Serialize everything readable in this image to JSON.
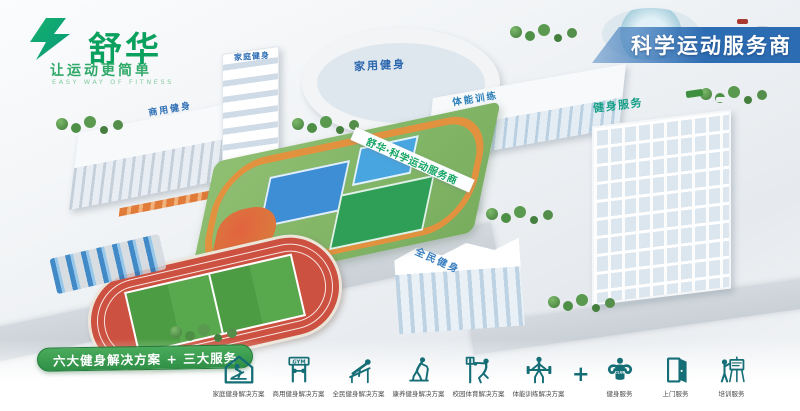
{
  "colors": {
    "brand_green": "#0aa05e",
    "ribbon_blue": "#2c6cb3",
    "banner_green": "#2e8f46",
    "icon_teal": "#156e76",
    "sign_green": "#14a563",
    "label_blue": "#2f6fb5"
  },
  "brand": {
    "name": "舒华",
    "slogan": "让运动更简单",
    "slogan_en": "EASY WAY OF FITNESS"
  },
  "ribbon": {
    "text": "科学运动服务商"
  },
  "banner": {
    "text": "六大健身解决方案 + 三大服务"
  },
  "scene": {
    "labels": [
      {
        "text": "商用健身"
      },
      {
        "text": "家庭健身"
      },
      {
        "text": "家用健身"
      },
      {
        "text": "体能训练"
      },
      {
        "text": "健身服务"
      },
      {
        "text": "舒华·科学运动服务商"
      },
      {
        "text": "全民健身"
      }
    ]
  },
  "solutions": [
    {
      "name": "home-fitness",
      "label": "家庭健身解决方案"
    },
    {
      "name": "commercial-fitness",
      "label": "商用健身解决方案",
      "icon_text": "GYM"
    },
    {
      "name": "public-fitness",
      "label": "全民健身解决方案"
    },
    {
      "name": "wellness-fitness",
      "label": "康养健身解决方案"
    },
    {
      "name": "campus-sports",
      "label": "校园体育解决方案"
    },
    {
      "name": "physical-training",
      "label": "体能训练解决方案"
    }
  ],
  "plus_sign": "+",
  "services": [
    {
      "name": "fitness-service",
      "label": "健身服务",
      "badge": "CLUB"
    },
    {
      "name": "doorstep-service",
      "label": "上门服务"
    },
    {
      "name": "training-service",
      "label": "培训服务"
    }
  ]
}
